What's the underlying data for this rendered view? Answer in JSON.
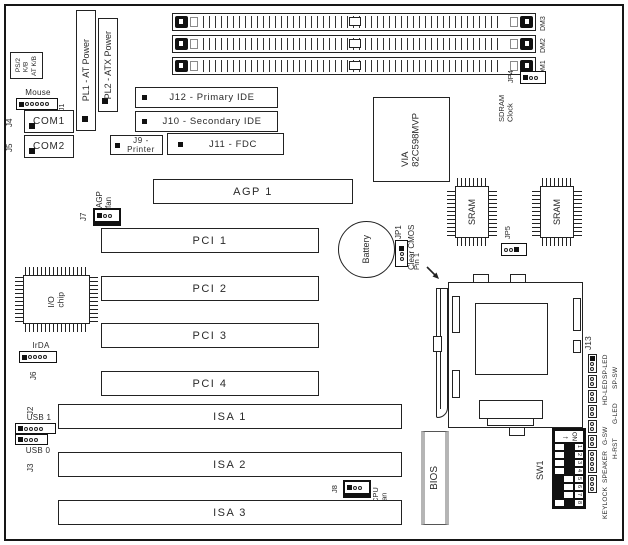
{
  "colors": {
    "line": "#222222",
    "fill_dark": "#111111",
    "gray": "#b5b5b5",
    "bg": "#ffffff"
  },
  "ports": {
    "ps2_kb": "PS/2\nK/B",
    "at_kb": "AT K/B",
    "mouse": "Mouse",
    "j1": "J1",
    "j4": "J4",
    "com1": "COM1",
    "j5": "J5",
    "com2": "COM2",
    "pl1": "PL1 - AT Power",
    "pl2": "PL2 - ATX Power",
    "j12": "J12 - Primary IDE",
    "j10": "J10 - Secondary IDE",
    "j9": "J9 - Printer",
    "j11": "J11 - FDC",
    "mouse_pins": [
      "f",
      "o",
      "o",
      "o",
      "o",
      "o"
    ]
  },
  "memory": {
    "dimm_labels": [
      "DM3",
      "DM2",
      "DM1"
    ],
    "jp4": {
      "label": "JP4",
      "pins": [
        "f",
        "o",
        "o"
      ]
    },
    "sdram_clock": "SDRAM\nClock"
  },
  "chips": {
    "northbridge": "VIA\n82C598MVP",
    "southbridge": "VIA\nVT82C586B",
    "sram": "SRAM",
    "io_chip": "I/O\nchip",
    "bios": "BIOS"
  },
  "jumpers": {
    "jp5": {
      "label": "JP5",
      "pins": [
        "o",
        "o",
        "f"
      ]
    },
    "jp1": {
      "label": "JP1",
      "sublabel": "Clear CMOS",
      "pins": [
        "f",
        "o",
        "o"
      ]
    }
  },
  "battery": {
    "label": "Battery"
  },
  "cpu": {
    "pin1": "Pin 1",
    "j13": "J13"
  },
  "slots": {
    "agp": "AGP 1",
    "pci": [
      "PCI 1",
      "PCI 2",
      "PCI 3",
      "PCI 4"
    ],
    "isa": [
      "ISA 1",
      "ISA 2",
      "ISA 3"
    ]
  },
  "fans": {
    "agp": {
      "j": "J7",
      "label": "AGP\nfan",
      "pins": [
        "f",
        "o",
        "o"
      ]
    },
    "cpu": {
      "j": "J8",
      "label": "CPU\nfan",
      "pins": [
        "f",
        "o",
        "o"
      ]
    }
  },
  "headers": {
    "irda": {
      "label": "IrDA",
      "j": "J6",
      "pins": [
        "f",
        "o",
        "o",
        "o",
        "o"
      ]
    },
    "usb": {
      "j2": "J2",
      "usb1": "USB 1",
      "usb0": "USB 0",
      "j3": "J3",
      "usb1_pins": [
        "f",
        "o",
        "o",
        "o",
        "o"
      ],
      "usb0_pins": [
        "f",
        "o",
        "o",
        "o"
      ]
    },
    "front_panel": {
      "labels": [
        "SP-LED",
        "SP-SW",
        "HD-LED",
        "G-LED",
        "G-SW",
        "H-RST",
        "SPEAKER",
        "KEYLOCK"
      ],
      "pin_groups": [
        [
          "f",
          "o",
          "o"
        ],
        [
          "o",
          "o"
        ],
        [
          "o",
          "o"
        ],
        [
          "o",
          "o"
        ],
        [
          "o",
          "o"
        ],
        [
          "o",
          "o"
        ],
        [
          "o",
          "o",
          "o",
          "o"
        ],
        [
          "o",
          "o",
          "o"
        ]
      ]
    }
  },
  "sw1": {
    "label": "SW1",
    "on_label": "ON",
    "switches": [
      {
        "n": "1",
        "pos": "r"
      },
      {
        "n": "2",
        "pos": "r"
      },
      {
        "n": "3",
        "pos": "r"
      },
      {
        "n": "4",
        "pos": "r"
      },
      {
        "n": "5",
        "pos": "l"
      },
      {
        "n": "6",
        "pos": "l"
      },
      {
        "n": "7",
        "pos": "l"
      },
      {
        "n": "8",
        "pos": "r"
      }
    ]
  }
}
